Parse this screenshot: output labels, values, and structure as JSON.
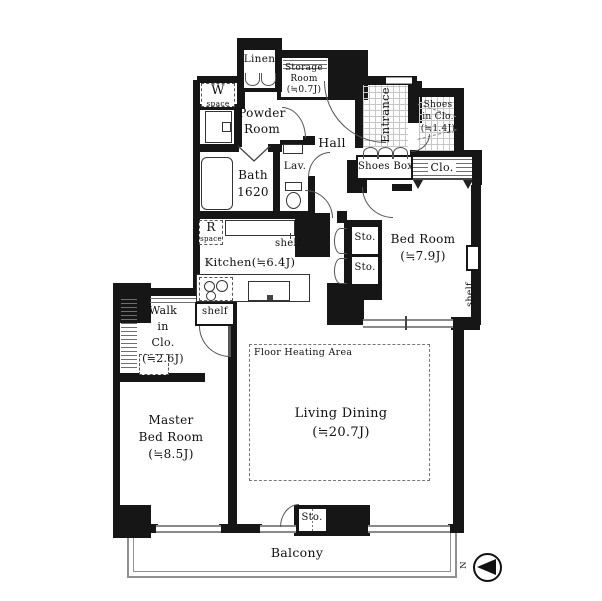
{
  "title": "Apartment floor plan",
  "colors": {
    "wall": "#161616",
    "line": "#555555",
    "window": "#8a8a8a",
    "bg": "#ffffff"
  },
  "rooms": {
    "linen": {
      "label": "Linen"
    },
    "storage": {
      "lines": [
        "Storage",
        "Room",
        "(≒0.7J)"
      ]
    },
    "w_space": {
      "lines": [
        "W",
        "space"
      ]
    },
    "powder": {
      "lines": [
        "Powder",
        "Room"
      ]
    },
    "bath": {
      "lines": [
        "Bath",
        "1620"
      ]
    },
    "lav": {
      "label": "Lav."
    },
    "hall": {
      "label": "Hall"
    },
    "entrance": {
      "label": "Entrance"
    },
    "shoes_in_clo": {
      "lines": [
        "Shoes",
        "in Clo.",
        "(≒1.4J)"
      ]
    },
    "shoes_box": {
      "label": "Shoes Box"
    },
    "clo": {
      "label": "Clo."
    },
    "bed_room": {
      "lines": [
        "Bed Room",
        "(≒7.9J)"
      ]
    },
    "sto_upper": {
      "label": "Sto."
    },
    "sto_lower": {
      "label": "Sto."
    },
    "sto_balcony": {
      "label": "Sto."
    },
    "r_space": {
      "lines": [
        "R",
        "space"
      ]
    },
    "kitchen": {
      "label": "Kitchen(≒6.4J)"
    },
    "kitchen_shelf": {
      "label": "shelf"
    },
    "walk_in_clo": {
      "lines": [
        "Walk",
        "in",
        "Clo.",
        "(≒2.6J)"
      ]
    },
    "wic_shelf": {
      "label": "shelf"
    },
    "bed_shelf": {
      "label": "shelf"
    },
    "master": {
      "lines": [
        "Master",
        "Bed Room",
        "(≒8.5J)"
      ]
    },
    "living": {
      "lines": [
        "Living Dining",
        "(≒20.7J)"
      ]
    },
    "floor_heating": {
      "label": "Floor Heating Area"
    },
    "balcony": {
      "label": "Balcony"
    },
    "compass": {
      "label": "N"
    }
  }
}
